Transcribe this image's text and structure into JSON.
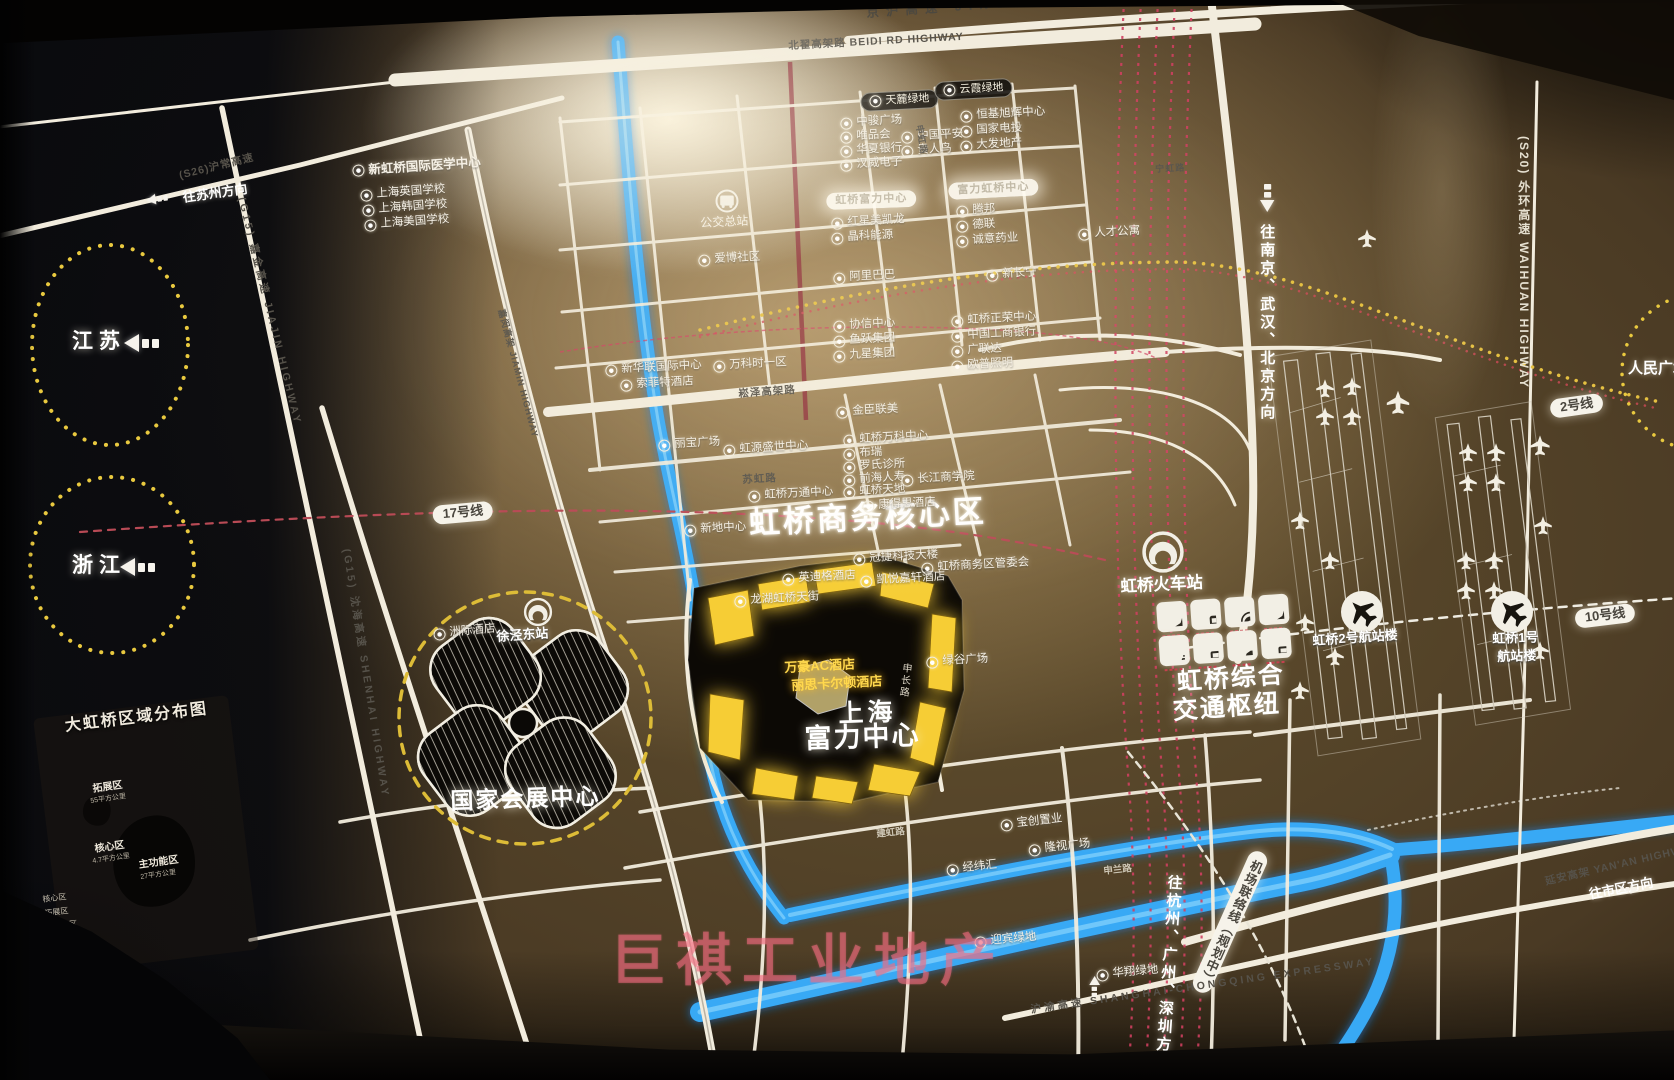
{
  "watermark": "巨祺工业地产",
  "colors": {
    "river": "#37a9f5",
    "road_white": "#f2ecdd",
    "rail_red": "#d04060",
    "metro_yellow": "#e5c041",
    "dashed_circle_yellow": "#e9c93f",
    "rf_building_yellow": "#f6cd35",
    "watermark_pink": "#f26c80"
  },
  "hub": {
    "icons": [
      {
        "name": "plane-icon"
      },
      {
        "name": "train-icon"
      },
      {
        "name": "metro-icon"
      },
      {
        "name": "plane-icon"
      },
      {
        "name": "scooter-icon"
      },
      {
        "name": "bus-icon"
      },
      {
        "name": "car-icon"
      },
      {
        "name": "bus-icon"
      }
    ]
  },
  "inset": {
    "title": "大虹桥区域分布图",
    "zones": [
      {
        "name": "拓展区",
        "area": "55平方公里"
      },
      {
        "name": "核心区",
        "area": "4.7平方公里"
      },
      {
        "name": "主功能区",
        "area": "27平方公里"
      }
    ],
    "legend": [
      "核心区",
      "拓展区",
      "主功能区"
    ]
  },
  "labels": [
    {
      "id": "core-area-title",
      "t": "虹桥商务核心区",
      "x": 748,
      "y": 506,
      "c": "t30",
      "r": -3
    },
    {
      "id": "rf-title-line1",
      "t": "上海",
      "x": 838,
      "y": 700,
      "c": "t26",
      "r": -2
    },
    {
      "id": "rf-title-line2",
      "t": "富力中心",
      "x": 804,
      "y": 724,
      "c": "t27",
      "r": -2
    },
    {
      "id": "necc-title",
      "t": "国家会展中心",
      "x": 450,
      "y": 788,
      "c": "t23",
      "r": -2
    },
    {
      "id": "hub-title-line1",
      "t": "虹桥综合",
      "x": 1176,
      "y": 668,
      "c": "t25",
      "r": -4
    },
    {
      "id": "hub-title-line2",
      "t": "交通枢纽",
      "x": 1172,
      "y": 697,
      "c": "t25",
      "r": -4
    },
    {
      "id": "station-label",
      "t": "虹桥火车站",
      "x": 1120,
      "y": 578,
      "c": "t16",
      "r": -3
    },
    {
      "id": "xujing-east-label",
      "t": "徐泾东站",
      "x": 496,
      "y": 630,
      "c": "t13",
      "r": -4
    },
    {
      "id": "terminal2-label",
      "t": "虹桥2号航站楼",
      "x": 1312,
      "y": 634,
      "c": "t13",
      "r": -4
    },
    {
      "id": "terminal1-label-1",
      "t": "虹桥1号",
      "x": 1492,
      "y": 632,
      "c": "t13",
      "r": -2
    },
    {
      "id": "terminal1-label-2",
      "t": "航站楼",
      "x": 1497,
      "y": 650,
      "c": "t13",
      "r": -2
    },
    {
      "id": "jiangsu-label",
      "t": "江苏",
      "x": 72,
      "y": 330,
      "c": "prov"
    },
    {
      "id": "zhejiang-label",
      "t": "浙江",
      "x": 72,
      "y": 554,
      "c": "prov"
    },
    {
      "id": "renmin-square-label",
      "t": "人民广场",
      "x": 1628,
      "y": 360,
      "c": "t15"
    },
    {
      "id": "inset-title",
      "t": "大虹桥区域分布图",
      "x": 64,
      "y": 718,
      "c": "t16w",
      "r": -7
    },
    {
      "id": "line17-pill",
      "t": "17号线",
      "x": 432,
      "y": 506,
      "c": "pillW",
      "r": -5
    },
    {
      "id": "line2-pill",
      "t": "2号线",
      "x": 1549,
      "y": 400,
      "c": "pillW",
      "r": -8
    },
    {
      "id": "line10-pill",
      "t": "10号线",
      "x": 1574,
      "y": 610,
      "c": "pillW",
      "r": -7
    },
    {
      "id": "airport-link-pill",
      "t": "机场联络线（规划中）",
      "x": 1252,
      "y": 848,
      "c": "pillW vertpill",
      "r": 24
    },
    {
      "id": "tianlu-green-pill",
      "t": "天麓绿地",
      "x": 860,
      "y": 93,
      "c": "pillD",
      "r": -3
    },
    {
      "id": "yunxia-green-pill",
      "t": "云霞绿地",
      "x": 934,
      "y": 82,
      "c": "pillD",
      "r": -3
    },
    {
      "id": "rf-glare-pill-1",
      "t": "虹桥富力中心",
      "x": 826,
      "y": 193,
      "c": "glare",
      "r": -2
    },
    {
      "id": "rf-glare-pill-2",
      "t": "富力虹桥中心",
      "x": 948,
      "y": 183,
      "c": "glare",
      "r": -3
    },
    {
      "id": "poi-med-center",
      "t": "新虹桥国际医学中心",
      "x": 352,
      "y": 164,
      "c": "poi pb",
      "r": -4
    },
    {
      "id": "poi-uk-school",
      "t": "上海英国学校",
      "x": 360,
      "y": 189,
      "c": "poi",
      "r": -4
    },
    {
      "id": "poi-kr-school",
      "t": "上海韩国学校",
      "x": 362,
      "y": 204,
      "c": "poi",
      "r": -4
    },
    {
      "id": "poi-us-school",
      "t": "上海美国学校",
      "x": 364,
      "y": 219,
      "c": "poi",
      "r": -4
    },
    {
      "id": "poi-zhongjun",
      "t": "中骏广场",
      "x": 840,
      "y": 117,
      "c": "poi",
      "r": -3
    },
    {
      "id": "poi-vip",
      "t": "唯品会",
      "x": 840,
      "y": 131,
      "c": "poi",
      "r": -3
    },
    {
      "id": "poi-huaxia-bank",
      "t": "华夏银行",
      "x": 840,
      "y": 145,
      "c": "poi",
      "r": -3
    },
    {
      "id": "poi-hanwei",
      "t": "汉威电子",
      "x": 840,
      "y": 159,
      "c": "poi",
      "r": -3
    },
    {
      "id": "poi-pingan",
      "t": "中国平安",
      "x": 901,
      "y": 131,
      "c": "poi",
      "r": -3
    },
    {
      "id": "poi-guirenniao",
      "t": "贵人鸟",
      "x": 901,
      "y": 145,
      "c": "poi",
      "r": -3
    },
    {
      "id": "poi-hengji",
      "t": "恒基旭辉中心",
      "x": 960,
      "y": 110,
      "c": "poi",
      "r": -3
    },
    {
      "id": "poi-spic",
      "t": "国家电投",
      "x": 960,
      "y": 125,
      "c": "poi",
      "r": -3
    },
    {
      "id": "poi-dafa",
      "t": "大发地产",
      "x": 960,
      "y": 140,
      "c": "poi",
      "r": -3
    },
    {
      "id": "poi-hongxing",
      "t": "红星美凯龙",
      "x": 831,
      "y": 217,
      "c": "poi",
      "r": -3
    },
    {
      "id": "poi-jinko",
      "t": "晶科能源",
      "x": 831,
      "y": 232,
      "c": "poi",
      "r": -3
    },
    {
      "id": "poi-tengbang",
      "t": "腾邦",
      "x": 956,
      "y": 205,
      "c": "poi",
      "r": -3
    },
    {
      "id": "poi-delian",
      "t": "德联",
      "x": 956,
      "y": 220,
      "c": "poi",
      "r": -3
    },
    {
      "id": "poi-chengyi",
      "t": "诚意药业",
      "x": 956,
      "y": 235,
      "c": "poi",
      "r": -3
    },
    {
      "id": "poi-rencai",
      "t": "人才公寓",
      "x": 1078,
      "y": 228,
      "c": "poi",
      "r": -3
    },
    {
      "id": "bus-terminal-label",
      "t": "公交总站",
      "x": 700,
      "y": 217,
      "c": "t12",
      "r": -3
    },
    {
      "id": "poi-aibo",
      "t": "爱博社区",
      "x": 698,
      "y": 254,
      "c": "poi",
      "r": -3
    },
    {
      "id": "poi-alibaba",
      "t": "阿里巴巴",
      "x": 833,
      "y": 272,
      "c": "poi",
      "r": -3
    },
    {
      "id": "poi-xinchangning",
      "t": "新长宁",
      "x": 986,
      "y": 269,
      "c": "poi",
      "r": -3
    },
    {
      "id": "poi-xiexin",
      "t": "协信中心",
      "x": 833,
      "y": 320,
      "c": "poi",
      "r": -3
    },
    {
      "id": "poi-yuyue",
      "t": "鱼跃集团",
      "x": 833,
      "y": 335,
      "c": "poi",
      "r": -3
    },
    {
      "id": "poi-jiuxing",
      "t": "九星集团",
      "x": 833,
      "y": 350,
      "c": "poi",
      "r": -3
    },
    {
      "id": "poi-zhengrong",
      "t": "虹桥正荣中心",
      "x": 951,
      "y": 315,
      "c": "poi",
      "r": -3
    },
    {
      "id": "poi-icbc",
      "t": "中国工商银行",
      "x": 951,
      "y": 330,
      "c": "poi",
      "r": -3
    },
    {
      "id": "poi-glodon",
      "t": "广联达",
      "x": 951,
      "y": 345,
      "c": "poi",
      "r": -3
    },
    {
      "id": "poi-opple",
      "t": "欧普照明",
      "x": 951,
      "y": 360,
      "c": "poi",
      "r": -3
    },
    {
      "id": "poi-xinhualian",
      "t": "新华联国际中心",
      "x": 605,
      "y": 364,
      "c": "poi",
      "r": -3
    },
    {
      "id": "poi-sofitel",
      "t": "索菲特酒店",
      "x": 620,
      "y": 379,
      "c": "poi",
      "r": -3
    },
    {
      "id": "poi-vanke-time",
      "t": "万科时一区",
      "x": 713,
      "y": 360,
      "c": "poi",
      "r": -3
    },
    {
      "id": "poi-jinchen",
      "t": "金臣联美",
      "x": 836,
      "y": 406,
      "c": "poi",
      "r": -3
    },
    {
      "id": "poi-vanke-center",
      "t": "虹桥万科中心",
      "x": 843,
      "y": 434,
      "c": "poi",
      "r": -3
    },
    {
      "id": "poi-burui",
      "t": "布瑞",
      "x": 843,
      "y": 448,
      "c": "poi",
      "r": -3
    },
    {
      "id": "poi-roche",
      "t": "罗氏诊所",
      "x": 843,
      "y": 461,
      "c": "poi",
      "r": -3
    },
    {
      "id": "poi-qianhai",
      "t": "前海人寿",
      "x": 843,
      "y": 474,
      "c": "poi",
      "r": -3
    },
    {
      "id": "poi-ckgsb",
      "t": "长江商学院",
      "x": 901,
      "y": 474,
      "c": "poi",
      "r": -3
    },
    {
      "id": "poi-libao",
      "t": "丽宝广场",
      "x": 658,
      "y": 439,
      "c": "poi",
      "r": -3
    },
    {
      "id": "poi-hongyuan",
      "t": "虹源盛世中心",
      "x": 723,
      "y": 444,
      "c": "poi",
      "r": -3
    },
    {
      "id": "poi-wantong",
      "t": "虹桥万通中心",
      "x": 748,
      "y": 490,
      "c": "poi",
      "r": -3
    },
    {
      "id": "poi-tiandi",
      "t": "虹桥天地",
      "x": 843,
      "y": 486,
      "c": "poi",
      "r": -3
    },
    {
      "id": "poi-langham",
      "t": "康得思酒店",
      "x": 862,
      "y": 500,
      "c": "poi",
      "r": -3
    },
    {
      "id": "poi-xindi",
      "t": "新地中心",
      "x": 684,
      "y": 524,
      "c": "poi",
      "r": -3
    },
    {
      "id": "poi-tpv",
      "t": "冠捷科技大楼",
      "x": 853,
      "y": 553,
      "c": "poi",
      "r": -3
    },
    {
      "id": "poi-guanweihui",
      "t": "虹桥商务区管委会",
      "x": 921,
      "y": 562,
      "c": "poi",
      "r": -3
    },
    {
      "id": "poi-indigo",
      "t": "英迪格酒店",
      "x": 782,
      "y": 573,
      "c": "poi",
      "r": -3
    },
    {
      "id": "poi-hyatt",
      "t": "凯悦嘉轩酒店",
      "x": 860,
      "y": 575,
      "c": "poi",
      "r": -3
    },
    {
      "id": "poi-longfor",
      "t": "龙湖虹桥天街",
      "x": 734,
      "y": 595,
      "c": "poi",
      "r": -3
    },
    {
      "id": "poi-lvgu",
      "t": "绿谷广场",
      "x": 926,
      "y": 656,
      "c": "poi",
      "r": -3
    },
    {
      "id": "poi-marriott-ac",
      "t": "万豪AC酒店",
      "x": 784,
      "y": 661,
      "c": "yel",
      "r": -3
    },
    {
      "id": "poi-ritz",
      "t": "丽思卡尔顿酒店",
      "x": 791,
      "y": 679,
      "c": "yel",
      "r": -3
    },
    {
      "id": "poi-baochuang",
      "t": "宝创置业",
      "x": 1000,
      "y": 819,
      "c": "poi",
      "r": -6
    },
    {
      "id": "poi-longshi",
      "t": "隆视广场",
      "x": 1028,
      "y": 844,
      "c": "poi",
      "r": -6
    },
    {
      "id": "poi-jingweihui",
      "t": "经纬汇",
      "x": 946,
      "y": 864,
      "c": "poi",
      "r": -6
    },
    {
      "id": "poi-yingbin",
      "t": "迎宾绿地",
      "x": 974,
      "y": 936,
      "c": "poi",
      "r": -5
    },
    {
      "id": "poi-huaxiang",
      "t": "华翔绿地",
      "x": 1096,
      "y": 969,
      "c": "poi",
      "r": -5
    },
    {
      "id": "poi-intercontinental",
      "t": "洲际酒店",
      "x": 433,
      "y": 628,
      "c": "poi",
      "r": -5
    },
    {
      "id": "hw-jinghu",
      "t": "京沪高速  JINGHU HIGHWAY",
      "x": 866,
      "y": 6,
      "c": "roadL",
      "r": -4
    },
    {
      "id": "hw-beidi",
      "t": "北翟高架路 BEIDI RD HIGHWAY",
      "x": 788,
      "y": 40,
      "c": "road",
      "r": -3
    },
    {
      "id": "hw-songze",
      "t": "崧泽高架路",
      "x": 738,
      "y": 388,
      "c": "road",
      "r": -4
    },
    {
      "id": "hw-s26",
      "t": "(S26)沪常高速",
      "x": 178,
      "y": 170,
      "c": "road",
      "r": -14
    },
    {
      "id": "hw-jiajin",
      "t": "(G15) 嘉金高速 JIAJIN HIGHWAY",
      "x": 247,
      "y": 196,
      "c": "road sp",
      "r": 76
    },
    {
      "id": "hw-shenhai",
      "t": "(G15) 沈海高速 SHENHAI HIGHWAY",
      "x": 352,
      "y": 548,
      "c": "road sp",
      "r": 81
    },
    {
      "id": "hw-jiamin",
      "t": "嘉闵高架 JIAMIN HIGHWAY",
      "x": 506,
      "y": 308,
      "c": "road t9",
      "r": 75
    },
    {
      "id": "hw-waihuan",
      "t": "(S20) 外环高速 WAIHUAN HIGHWAY",
      "x": 1516,
      "y": 136,
      "c": "dirVW"
    },
    {
      "id": "hw-yanan",
      "t": "延安高架 YAN'AN HIGHWAY",
      "x": 1544,
      "y": 876,
      "c": "road",
      "r": -13
    },
    {
      "id": "hw-huyu",
      "t": "沪渝高速 SHANGHAI-CHONGQING EXPRESSWAY",
      "x": 1030,
      "y": 1004,
      "c": "road sp",
      "r": -8
    },
    {
      "id": "rd-suhong",
      "t": "苏虹路",
      "x": 742,
      "y": 474,
      "c": "road",
      "r": -3
    },
    {
      "id": "rd-shenchang",
      "t": "申长路",
      "x": 900,
      "y": 662,
      "c": "rv",
      "r": 6
    },
    {
      "id": "rd-ninghong",
      "t": "宁虹路",
      "x": 1155,
      "y": 164,
      "c": "road t9",
      "r": -3
    },
    {
      "id": "rd-shenhong",
      "t": "申虹路",
      "x": 924,
      "y": 124,
      "c": "road t9",
      "r": 80
    },
    {
      "id": "rd-jianhong",
      "t": "建虹路",
      "x": 876,
      "y": 830,
      "c": "roadW",
      "r": -6
    },
    {
      "id": "rd-shenlan",
      "t": "申兰路",
      "x": 1103,
      "y": 867,
      "c": "roadW",
      "r": -6
    },
    {
      "id": "dir-suzhou",
      "t": "往苏州方向",
      "x": 182,
      "y": 191,
      "c": "dir s13",
      "r": -8
    },
    {
      "id": "dir-city",
      "t": "往市区方向",
      "x": 1588,
      "y": 888,
      "c": "dir s13",
      "r": -11
    },
    {
      "id": "dir-north",
      "t": "往南京、武汉、北京方向",
      "x": 1258,
      "y": 224,
      "c": "dirV"
    },
    {
      "id": "dir-south",
      "t": "往杭州、广州、深圳方向",
      "x": 1166,
      "y": 874,
      "c": "dirV s13",
      "r": 4
    },
    {
      "id": "zone-tuozhan",
      "t": "拓展区",
      "x": 92,
      "y": 784,
      "c": "zone",
      "r": -8
    },
    {
      "id": "zone-tuozhan-area",
      "t": "55平方公里",
      "x": 90,
      "y": 798,
      "c": "zoneA",
      "r": -8
    },
    {
      "id": "zone-hexin",
      "t": "核心区",
      "x": 94,
      "y": 844,
      "c": "zone",
      "r": -8
    },
    {
      "id": "zone-hexin-area",
      "t": "4.7平方公里",
      "x": 92,
      "y": 858,
      "c": "zoneA",
      "r": -8
    },
    {
      "id": "zone-zhugongneng",
      "t": "主功能区",
      "x": 138,
      "y": 860,
      "c": "zone",
      "r": -8
    },
    {
      "id": "zone-zhugongneng-area",
      "t": "27平方公里",
      "x": 140,
      "y": 874,
      "c": "zoneA",
      "r": -8
    },
    {
      "id": "legend-hexin",
      "t": "核心区",
      "x": 42,
      "y": 895,
      "c": "tl",
      "r": -7
    },
    {
      "id": "legend-tuozhan",
      "t": "拓展区",
      "x": 44,
      "y": 909,
      "c": "tl",
      "r": -7
    },
    {
      "id": "legend-zhugongneng",
      "t": "主功能区",
      "x": 45,
      "y": 923,
      "c": "tl",
      "r": -7
    },
    {
      "id": "arrow-jiangsu",
      "t": "",
      "x": 124,
      "y": 334,
      "c": "arr"
    },
    {
      "id": "arrow-zhejiang",
      "t": "",
      "x": 120,
      "y": 558,
      "c": "arr"
    },
    {
      "id": "arrow-suzhou",
      "t": "",
      "x": 146,
      "y": 195,
      "c": "arr",
      "r": -8,
      "s": 0.6
    },
    {
      "id": "arrow-north",
      "t": "",
      "x": 1260,
      "y": 212,
      "c": "arr",
      "r": -90,
      "s": 0.8
    },
    {
      "id": "arrow-south",
      "t": "",
      "x": 1100,
      "y": 976,
      "c": "arr",
      "r": 90,
      "s": 0.6
    },
    {
      "id": "arrow-city",
      "t": "",
      "x": 1638,
      "y": 894,
      "c": "arr",
      "r": 180,
      "s": 0.5
    }
  ]
}
